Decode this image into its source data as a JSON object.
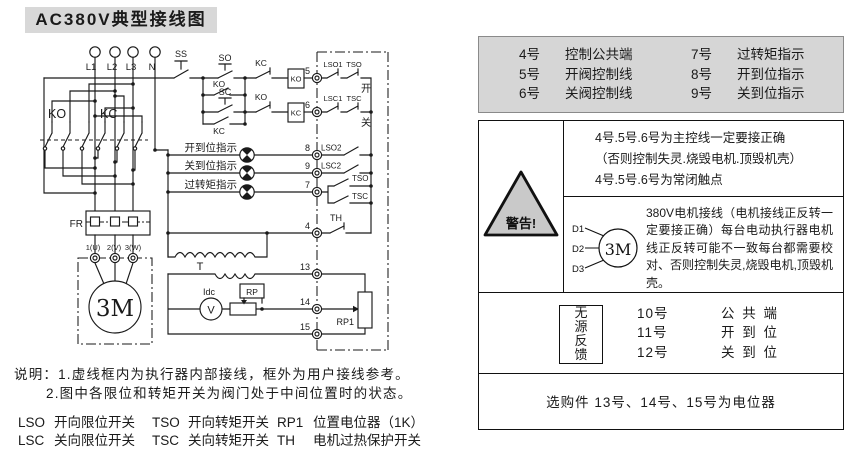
{
  "title": "AC380V典型接线图",
  "colors": {
    "gray": "#d6d6d6",
    "line": "#1a1a1a"
  },
  "diagram": {
    "l1": "L1",
    "l2": "L2",
    "l3": "L3",
    "n": "N",
    "ko_group": "KO",
    "kc_group": "KC",
    "ss": "SS",
    "so": "SO",
    "sc": "SC",
    "ko_hold": "KO",
    "kc_hold": "KC",
    "kc_interlock": "KC",
    "ko_interlock": "KO",
    "ko_coil": "KO",
    "kc_coil": "KC",
    "t4": "4",
    "t5": "5",
    "t6": "6",
    "t7": "7",
    "t8": "8",
    "t9": "9",
    "t13": "13",
    "t14": "14",
    "t15": "15",
    "lso1": "LSO1",
    "tso1": "TSO",
    "open_char": "开",
    "lsc1": "LSC1",
    "tsc1": "TSC",
    "close_char": "关",
    "lso2": "LSO2",
    "lsc2": "LSC2",
    "tso2": "TSO",
    "tsc2": "TSC",
    "th": "TH",
    "lamp_open": "开到位指示",
    "lamp_close": "关到位指示",
    "lamp_torque": "过转矩指示",
    "fr": "FR",
    "m1": "1(U)",
    "m2": "2(V)",
    "m3": "3(W)",
    "motor": "3M",
    "t_label": "T",
    "idc": "Idc",
    "v": "V",
    "rp": "RP",
    "rp1": "RP1"
  },
  "panel": {
    "terminal_rows": [
      [
        "4号",
        "控制公共端",
        "7号",
        "过转矩指示"
      ],
      [
        "5号",
        "开阀控制线",
        "8号",
        "开到位指示"
      ],
      [
        "6号",
        "关阀控制线",
        "9号",
        "关到位指示"
      ]
    ],
    "warning_label": "警告!",
    "warn_lines": [
      "4号.5号.6号为主控线一定要接正确",
      "（否则控制失灵.烧毁电机.顶毁机壳）",
      "4号.5号.6号为常闭触点"
    ],
    "motor_leads": [
      "D1",
      "D2",
      "D3"
    ],
    "motor_label": "3M",
    "warn2_text": "380V电机接线（电机接线正反转一定要接正确）每台电动执行器电机线正反转可能不一致每台都需要校对、否则控制失灵,烧毁电机,顶毁机壳。",
    "feedback_label": "无源反馈",
    "feedback_rows": [
      [
        "10号",
        "公 共 端"
      ],
      [
        "11号",
        "开 到 位"
      ],
      [
        "12号",
        "关 到 位"
      ]
    ],
    "optional_text": "选购件 13号、14号、15号为电位器"
  },
  "notes": {
    "line1": "说明：1.虚线框内为执行器内部接线，框外为用户接线参考。",
    "line2": "2.图中各限位和转矩开关为阀门处于中间位置时的状态。"
  },
  "legend": {
    "rows": [
      [
        {
          "abbr": "LSO",
          "desc": "开向限位开关"
        },
        {
          "abbr": "TSO",
          "desc": "开向转矩开关"
        },
        {
          "abbr": "RP1",
          "desc": "位置电位器（1K）"
        }
      ],
      [
        {
          "abbr": "LSC",
          "desc": "关向限位开关"
        },
        {
          "abbr": "TSC",
          "desc": "关向转矩开关"
        },
        {
          "abbr": "TH",
          "desc": "电机过热保护开关"
        }
      ]
    ]
  }
}
